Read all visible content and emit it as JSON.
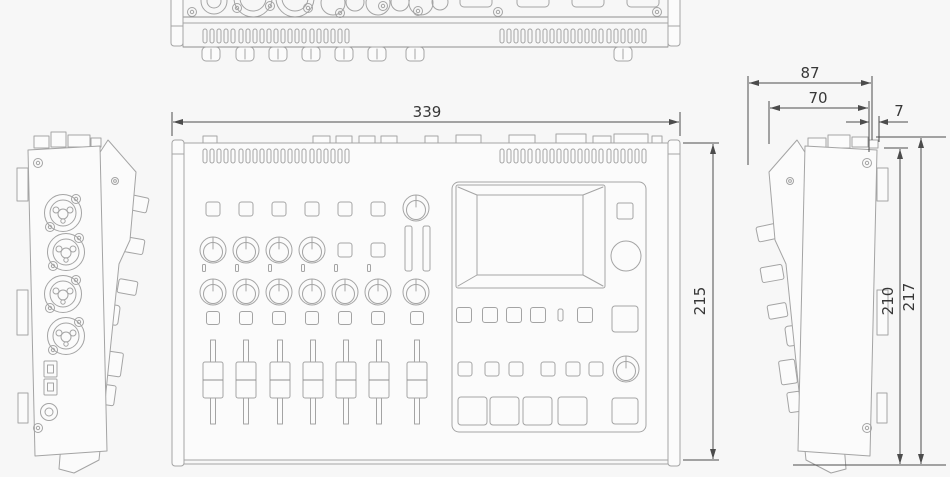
{
  "dimensions": {
    "plan_width": "339",
    "plan_depth": "215",
    "side_depth_total": "87",
    "side_top_depth": "70",
    "side_rear_offset": "7",
    "side_height_body": "210",
    "side_height_total": "217"
  },
  "colors": {
    "page-bg": "#f7f7f7",
    "paper": "#fbfbfb",
    "outline": "#a4a4a4",
    "outline-strong": "#8f8f8f",
    "dim-line": "#4c4c4c",
    "dim-text": "#383838"
  }
}
